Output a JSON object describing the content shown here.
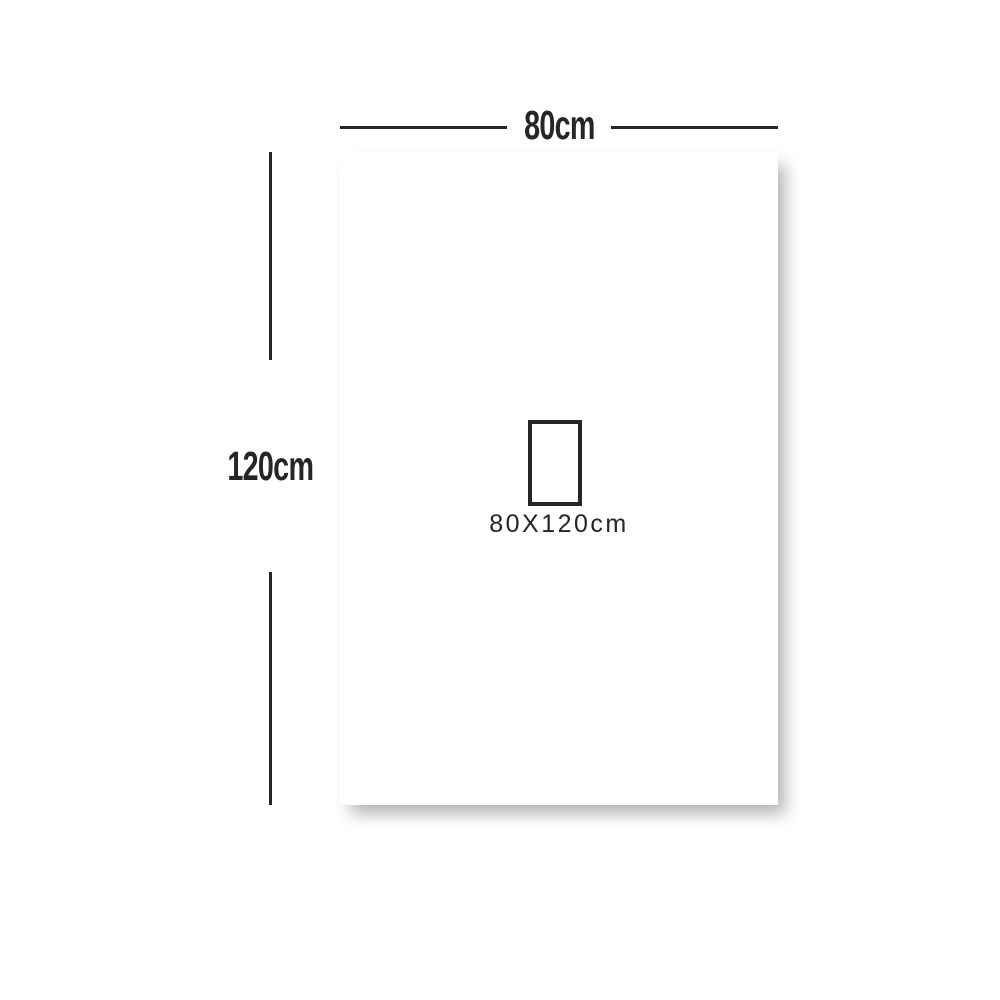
{
  "diagram": {
    "title": "product-dimension-diagram",
    "width_label": "80cm",
    "height_label": "120cm",
    "size_label": "80X120cm"
  },
  "colors": {
    "line": "#262626",
    "panel": "#ffffff",
    "background": "#ffffff",
    "shadow": "rgba(0,0,0,0.30)"
  }
}
